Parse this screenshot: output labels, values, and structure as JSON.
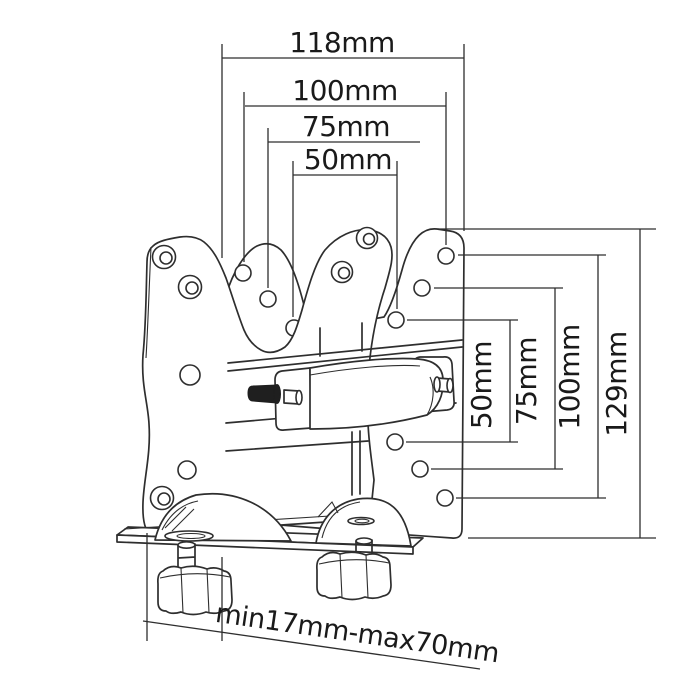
{
  "page": {
    "background": "#ffffff"
  },
  "colors": {
    "line": "#2e2e2e",
    "text": "#1a1a1a",
    "bolt_fill": "#1f1f1f",
    "plate_fill": "#ffffff"
  },
  "dimensions": {
    "top": [
      {
        "name": "overall-width",
        "label": "118mm"
      },
      {
        "name": "vesa-width-100",
        "label": "100mm"
      },
      {
        "name": "vesa-width-75",
        "label": "75mm"
      },
      {
        "name": "vesa-width-50",
        "label": "50mm"
      }
    ],
    "right": [
      {
        "name": "vesa-height-50",
        "label": "50mm"
      },
      {
        "name": "vesa-height-75",
        "label": "75mm"
      },
      {
        "name": "vesa-height-100",
        "label": "100mm"
      },
      {
        "name": "overall-height",
        "label": "129mm"
      }
    ],
    "bottom": {
      "name": "clamp-range",
      "label": "min17mm-max70mm"
    }
  }
}
